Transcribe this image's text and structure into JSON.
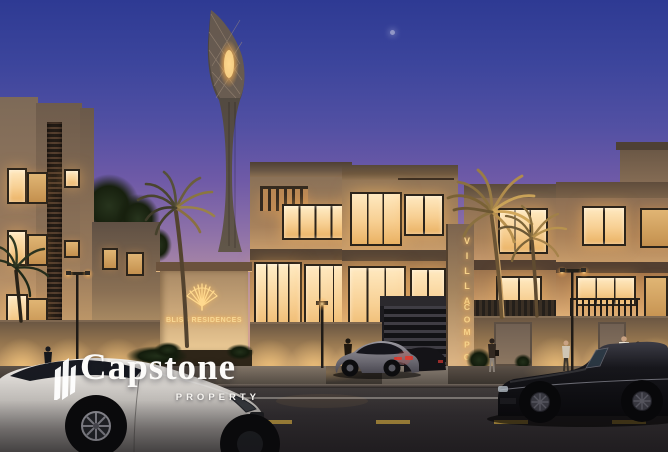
{
  "scene": {
    "type": "architectural dusk rendering",
    "subject": "luxury villa compound street elevation with illuminated lattice tower landmark, palm trees, boundary wall and three cars on the street"
  },
  "watermark": {
    "brand": "Capstone",
    "tagline": "PROPERTY"
  },
  "signage": {
    "pillar": {
      "line1": "VILLA",
      "line2": "COMPOUND"
    },
    "monument": {
      "name": "BLISS RESIDENCES"
    }
  },
  "palette": {
    "sky_top": "#2e3a93",
    "sky_horizon": "#e6b591",
    "facade_warm": "#c9a06c",
    "window_glow": "#ffe4b2",
    "signage_gold": "#f6d28a",
    "tower_glow": "#ffc566",
    "street_asphalt": "#2d2a2d",
    "lane_marking_yellow": "#c7a243",
    "lane_marking_white": "#cfc9c2",
    "watermark_white": "#fcfbf9"
  },
  "vehicles": [
    {
      "type": "white coupe",
      "position": "foreground left"
    },
    {
      "type": "gray coupe",
      "position": "parked at compound gate"
    },
    {
      "type": "black convertible with two occupants",
      "position": "driving right"
    }
  ]
}
